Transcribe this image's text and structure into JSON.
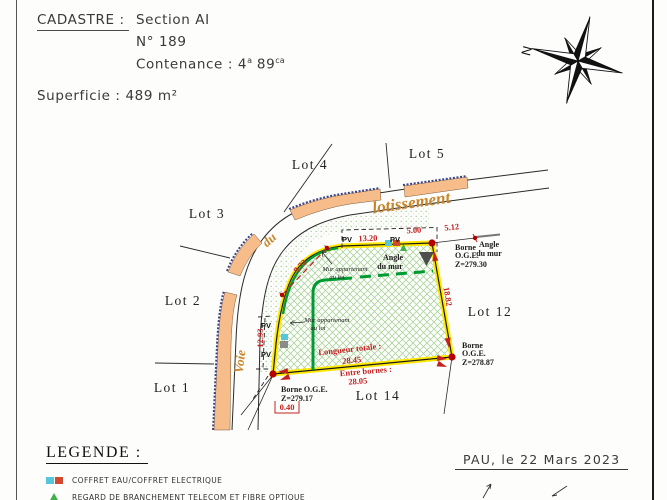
{
  "header": {
    "cadastre_label": "CADASTRE :",
    "section": "Section AI",
    "numero": "N° 189",
    "contenance_label": "Contenance : ",
    "contenance_v1": "4",
    "contenance_s1": "a",
    "contenance_v2": "89",
    "contenance_s2": "ca",
    "superficie": "Superficie : 489 m²"
  },
  "compass": {
    "north": "N"
  },
  "plan": {
    "street": {
      "voie": "Voie",
      "du": "du",
      "lotissement": "lotissement"
    },
    "lots": {
      "lot1": "Lot 1",
      "lot2": "Lot 2",
      "lot3": "Lot 3",
      "lot4": "Lot 4",
      "lot5": "Lot 5",
      "lot12": "Lot 12",
      "lot14": "Lot 14"
    },
    "measures": {
      "pv_top": "13.20",
      "seg_500": "5.00",
      "seg_512": "5.12",
      "right_side": "18.82",
      "diagonal": "9.72",
      "pv_left": "12.93",
      "longueur_label": "Longueur totale :",
      "longueur_value": "28.45",
      "entre_label": "Entre bornes :",
      "entre_value": "28.05",
      "offset_value": "0.40"
    },
    "labels": {
      "pv": "PV",
      "angle1": "Angle",
      "angle2": "du mur",
      "borne1": "Borne",
      "borne2": "O.G.E.",
      "z_top": "Z=279.30",
      "z_right": "Z=278.87",
      "borne_bottom": "Borne O.G.E.",
      "z_bottom": "Z=279.17",
      "mur1": "Mur appartenant",
      "mur2": "au lot"
    }
  },
  "legend": {
    "title": "LEGENDE :",
    "items": [
      {
        "icon": "coffret-eau-electrique-icon",
        "label": "COFFRET EAU/COFFRET ELECTRIQUE"
      },
      {
        "icon": "regard-telecom-icon",
        "label": "REGARD DE BRANCHEMENT TELECOM ET FIBRE OPTIQUE"
      }
    ]
  },
  "footer": {
    "place_date": "PAU, le 22 Mars 2023"
  },
  "colors": {
    "measure_red": "#c42222",
    "wall_orange": "#f6bd8b",
    "street_orange": "#c8862c",
    "boundary_yellow": "#ffe800",
    "hatch_green": "#abd49a",
    "wall_green": "#009a33",
    "edge_navy": "#3a4288",
    "borne_red": "#b30000",
    "coffret_cyan": "#55c6dc",
    "coffret_red": "#d04a32",
    "telecom_green": "#3db04b",
    "marker_gray": "#8a8a8a",
    "angle_triangle_gray": "#4d4d4d"
  }
}
